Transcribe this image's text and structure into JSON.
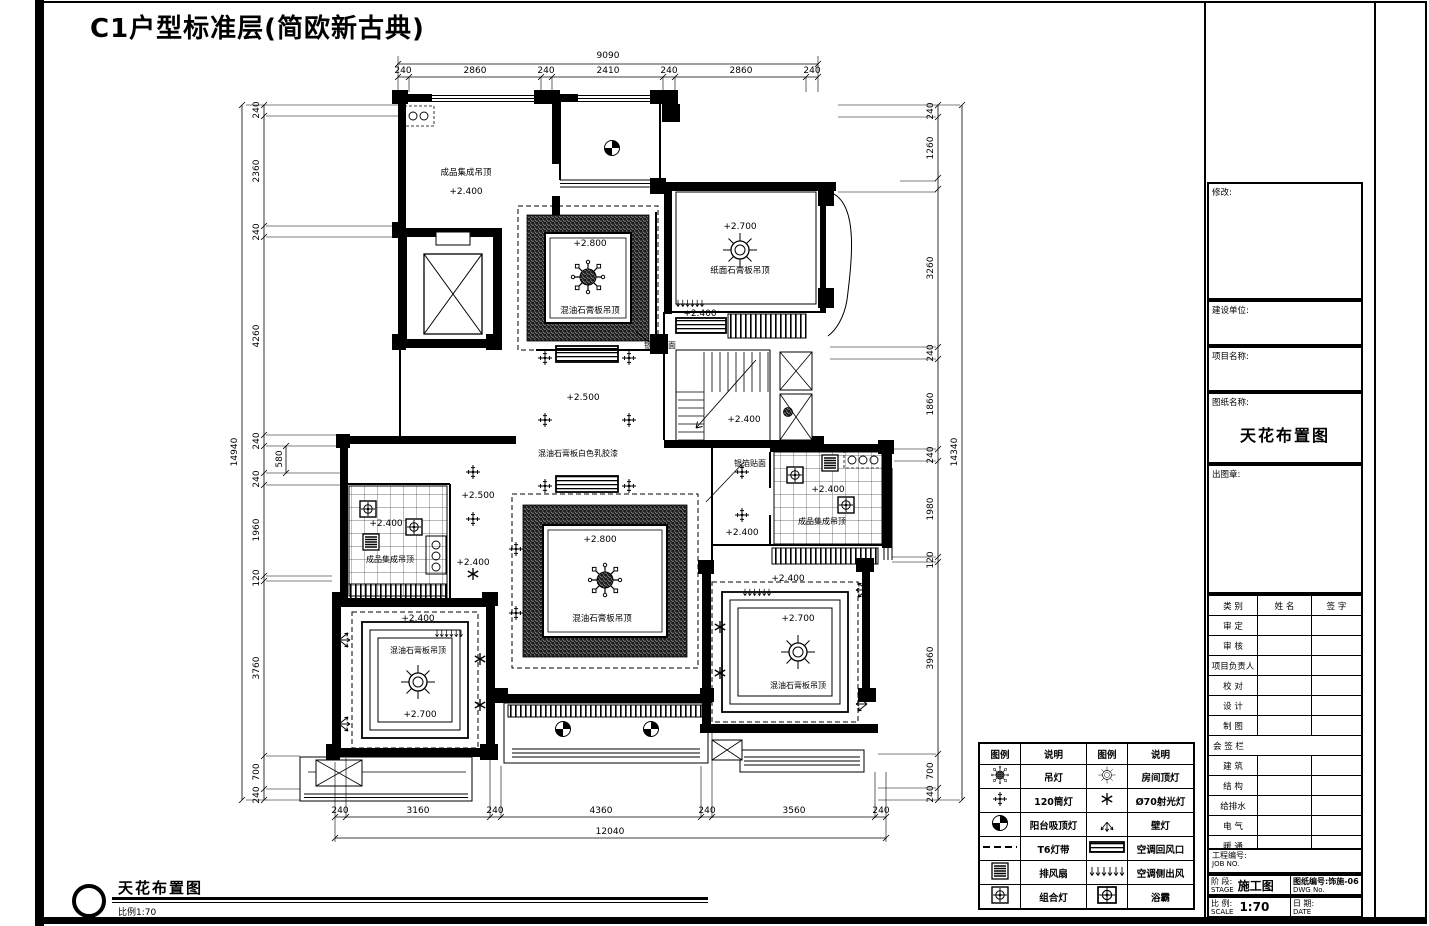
{
  "page_title": "C1户型标准层(简欧新古典)",
  "footer": {
    "title": "天花布置图",
    "scale": "比例1:70"
  },
  "plan": {
    "labels": [
      {
        "text": "成品集成吊顶"
      },
      {
        "text": "+2.400"
      },
      {
        "text": "+2.800"
      },
      {
        "text": "混油石膏板吊顶"
      },
      {
        "text": "+2.700"
      },
      {
        "text": "纸面石膏板吊顶"
      },
      {
        "text": "+2.400"
      },
      {
        "text": "+2.400"
      },
      {
        "text": "+2.500"
      },
      {
        "text": "混油石膏板白色乳胶漆"
      },
      {
        "text": "银箔贴面"
      },
      {
        "text": "银箔贴面"
      },
      {
        "text": "+2.500"
      },
      {
        "text": "+2.400"
      },
      {
        "text": "成品集成吊顶"
      },
      {
        "text": "+2.400"
      },
      {
        "text": "+2.400"
      },
      {
        "text": "混油石膏板吊顶"
      },
      {
        "text": "+2.700"
      },
      {
        "text": "+2.800"
      },
      {
        "text": "混油石膏板吊顶"
      },
      {
        "text": "+2.400"
      },
      {
        "text": "成品集成吊顶"
      },
      {
        "text": "+2.400"
      },
      {
        "text": "+2.400"
      },
      {
        "text": "+2.700"
      },
      {
        "text": "混油石膏板吊顶"
      }
    ],
    "dims": {
      "top": {
        "total": "9090",
        "segments": [
          "240",
          "2860",
          "240",
          "2410",
          "240",
          "2860",
          "240"
        ]
      },
      "bottom": {
        "total": "12040",
        "segments": [
          "240",
          "3160",
          "240",
          "4360",
          "240",
          "3560",
          "240"
        ]
      },
      "left": {
        "total": "14940",
        "segments": [
          "240",
          "2360",
          "240",
          "4260",
          "240",
          "580",
          "240",
          "1960",
          "120",
          "3760",
          "700",
          "240"
        ]
      },
      "right": {
        "total": "14340",
        "segments": [
          "240",
          "1260",
          "3260",
          "240",
          "1860",
          "240",
          "1980",
          "120",
          "3960",
          "700",
          "240"
        ]
      }
    }
  },
  "legend": {
    "headers": [
      "图例",
      "说明",
      "图例",
      "说明"
    ],
    "rows": [
      {
        "left": "吊灯",
        "right": "房间顶灯"
      },
      {
        "left": "120筒灯",
        "right": "Ø70射光灯"
      },
      {
        "left": "阳台吸顶灯",
        "right": "壁灯"
      },
      {
        "left": "T6灯带",
        "right": "空调回风口"
      },
      {
        "left": "排风扇",
        "right": "空调侧出风"
      },
      {
        "left": "组合灯",
        "right": "浴霸"
      }
    ]
  },
  "titleblock": {
    "revision": "修改:",
    "client": "建设单位:",
    "project": "项目名称:",
    "sheet_name_label": "图纸名称:",
    "sheet_name": "天花布置图",
    "stamp": "出图章:",
    "sign_table": {
      "headers": [
        "类 别",
        "姓 名",
        "签 字"
      ],
      "rows": [
        "审 定",
        "审 核",
        "项目负责人",
        "校 对",
        "设 计",
        "制 图"
      ],
      "countersign": "会 签 栏",
      "rows2": [
        "建 筑",
        "结 构",
        "给排水",
        "电 气",
        "暖 通"
      ]
    },
    "job_no_label": "工程编号:",
    "job_no_en": "JOB NO.",
    "stage_label": "阶 段:",
    "stage_en": "STAGE",
    "stage_value": "施工图",
    "dwg_no_label": "图纸编号:",
    "dwg_no_en": "DWG No.",
    "dwg_no_value": "饰施-06",
    "scale_label": "比 例:",
    "scale_en": "SCALE",
    "scale_value": "1:70",
    "date_label": "日 期:",
    "date_en": "DATE"
  }
}
